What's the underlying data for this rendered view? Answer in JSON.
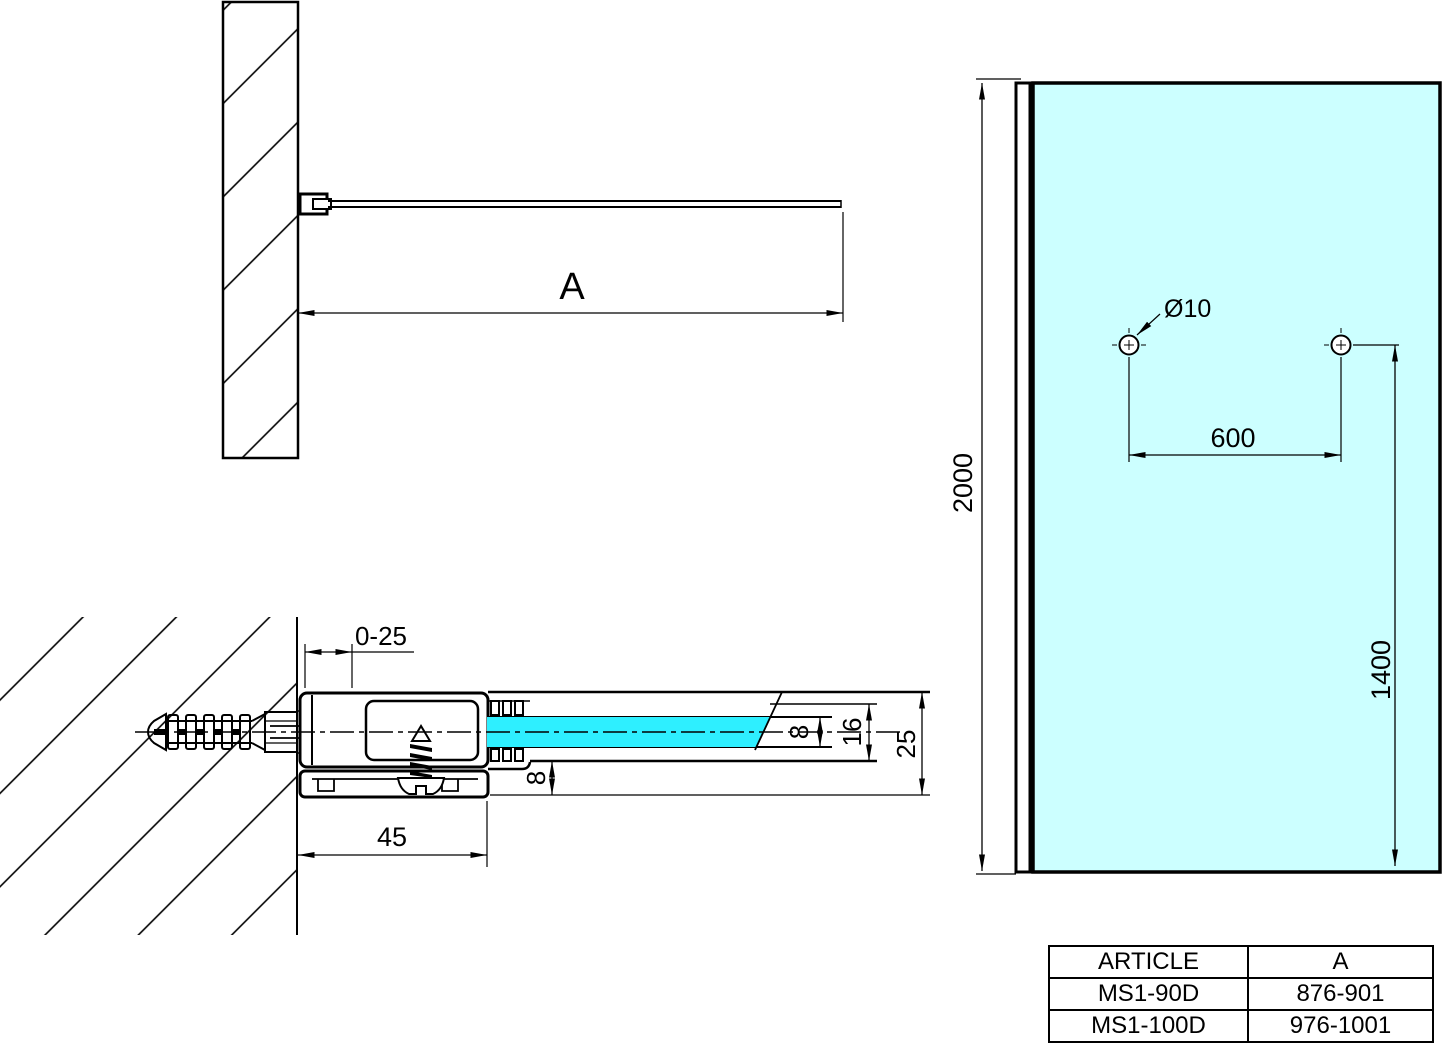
{
  "plan": {
    "dim_a": "A"
  },
  "section": {
    "dim_range": "0-25",
    "dim_width": "45",
    "dim_glass": "8",
    "dim_channel": "16",
    "dim_total": "25",
    "dim_bottom": "8"
  },
  "front": {
    "dim_height": "2000",
    "dim_spacing": "600",
    "dim_hole_v": "1400",
    "dim_hole_d": "Ø10"
  },
  "colors": {
    "glass_front": "#CCFFFF",
    "glass_section": "#2EEFFF",
    "line": "#000000"
  },
  "table": {
    "headers": [
      "ARTICLE",
      "A"
    ],
    "rows": [
      {
        "article": "MS1-90D",
        "a": "876-901"
      },
      {
        "article": "MS1-100D",
        "a": "976-1001"
      }
    ]
  }
}
